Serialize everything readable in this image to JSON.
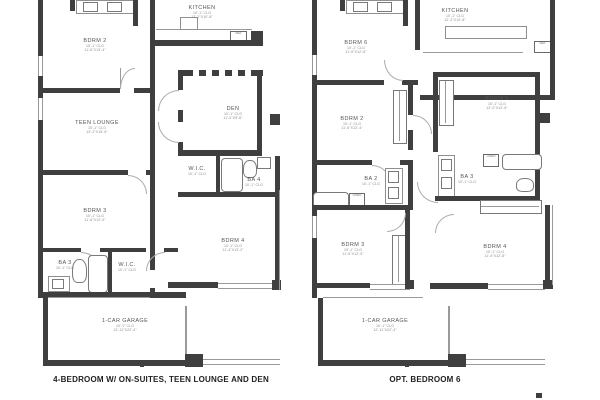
{
  "colors": {
    "wall": "#3f3f3f",
    "line": "#9a9a9a",
    "label": "#555555",
    "dim": "#8a8a8a",
    "caption": "#222222"
  },
  "plans": [
    {
      "caption": "4-BEDROOM W/ ON-SUITES, TEEN LOUNGE AND DEN",
      "rooms": {
        "kitchen": {
          "name": "KITCHEN",
          "clg": "10'-1\" CLG",
          "size": "12'-2\"X10'-8\""
        },
        "bdrm2": {
          "name": "BDRM 2",
          "clg": "10'-1\" CLG",
          "size": "11'-6\"X13'-4\""
        },
        "teen_lounge": {
          "name": "TEEN LOUNGE",
          "clg": "10'-1\" CLG",
          "size": "13'-2\"X15'-6\""
        },
        "den": {
          "name": "DEN",
          "clg": "10'-1\" CLG",
          "size": "11'-0\"X9'-6\""
        },
        "wic_mid": {
          "name": "W.I.C.",
          "clg": "10'-1\" CLG"
        },
        "ba4": {
          "name": "BA 4",
          "clg": "10'-1\" CLG"
        },
        "bdrm3": {
          "name": "BDRM 3",
          "clg": "10'-1\" CLG",
          "size": "11'-6\"X12'-0\""
        },
        "ba3": {
          "name": "BA 3",
          "clg": "10'-1\" CLG"
        },
        "wic_low": {
          "name": "W.I.C.",
          "clg": "10'-1\" CLG"
        },
        "bdrm4": {
          "name": "BDRM 4",
          "clg": "10'-1\" CLG",
          "size": "11'-4\"X13'-2\""
        },
        "garage": {
          "name": "1-CAR GARAGE",
          "clg": "10'-1\" CLG",
          "size": "12'-11\"X22'-4\""
        },
        "ref": {
          "name": "REF"
        }
      }
    },
    {
      "caption": "OPT. BEDROOM 6",
      "rooms": {
        "kitchen": {
          "name": "KITCHEN",
          "clg": "10'-1\" CLG",
          "size": "12'-2\"X10'-8\""
        },
        "bdrm6": {
          "name": "BDRM 6",
          "clg": "10'-1\" CLG",
          "size": "11'-6\"X12'-6\""
        },
        "bdrm2": {
          "name": "BDRM 2",
          "clg": "10'-1\" CLG",
          "size": "11'-6\"X12'-4\""
        },
        "ba2": {
          "name": "BA 2",
          "clg": "10'-1\" CLG"
        },
        "ba3": {
          "name": "BA 3",
          "clg": "10'-1\" CLG"
        },
        "linen_a": {
          "name": "LINEN"
        },
        "linen_b": {
          "name": "LINEN"
        },
        "bdrm5": {
          "name": "BDRM 5",
          "clg": "10'-1\" CLG",
          "size": "12'-0\"X12'-6\""
        },
        "bdrm3": {
          "name": "BDRM 3",
          "clg": "10'-1\" CLG",
          "size": "11'-6\"X12'-0\""
        },
        "bdrm4": {
          "name": "BDRM 4",
          "clg": "10'-1\" CLG",
          "size": "11'-4\"X12'-8\""
        },
        "garage": {
          "name": "1-CAR GARAGE",
          "clg": "10'-1\" CLG",
          "size": "12'-11\"X22'-4\""
        },
        "ref": {
          "name": "REF"
        }
      }
    }
  ]
}
